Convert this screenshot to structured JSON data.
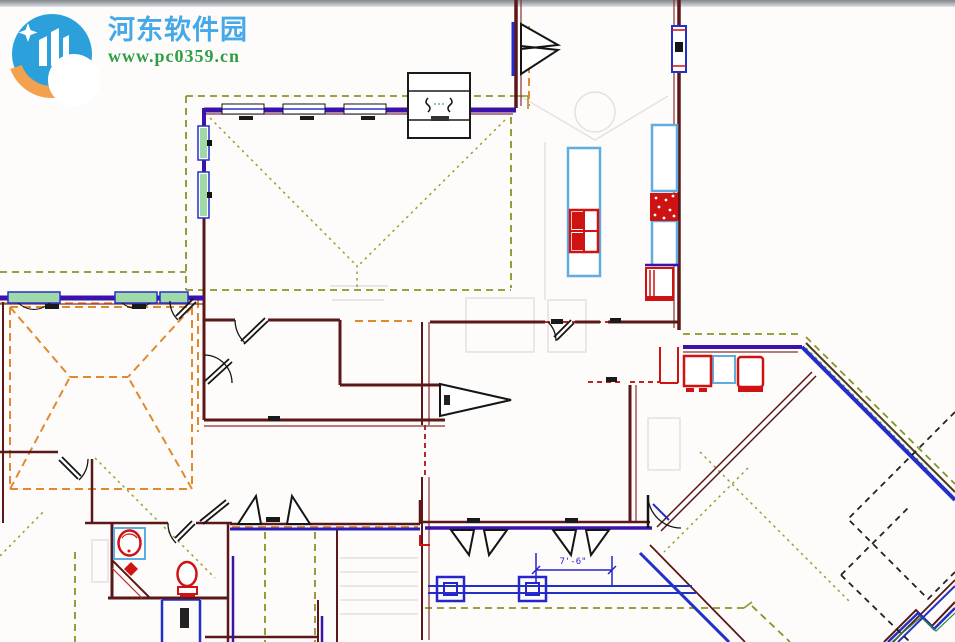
{
  "watermark": {
    "site_name": "河东软件园",
    "site_url": "www.pc0359.cn",
    "name_color": "#45a9e9",
    "url_color": "#2f9e44",
    "logo_blue": "#2ba0da",
    "logo_orange": "#f2a14e",
    "logo_icon": "hedong-circle-logo"
  },
  "floorplan": {
    "dimension_label": "7'-6\"",
    "colors": {
      "wall_maroon": "#5c1818",
      "wall_purple": "#3b13aa",
      "wall_blue": "#2030c8",
      "roof_dash_olive": "#8e9226",
      "roof_dash_orange": "#e08a2e",
      "opening_dash_red": "#bb2626",
      "fixture_red": "#cf1212",
      "counter_blue": "#5fade0",
      "window_green": "#9fd9a8",
      "door_black": "#151515",
      "dimension_blue": "#2525cc"
    }
  }
}
